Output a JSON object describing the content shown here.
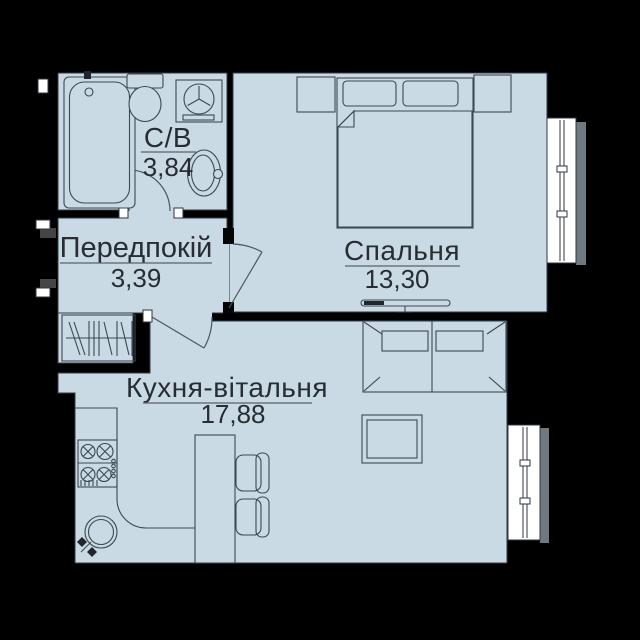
{
  "plan": {
    "title": "apartment-floor-plan",
    "background_color": "#000000",
    "floor_color": "#c9dae4",
    "line_color": "#3c4852",
    "text_color": "#272d33",
    "window_shadow_color": "#707880",
    "rooms": [
      {
        "name": "С/В",
        "area": "3,84"
      },
      {
        "name": "Передпокій",
        "area": "3,39"
      },
      {
        "name": "Спальня",
        "area": "13,30"
      },
      {
        "name": "Кухня-вітальня",
        "area": "17,88"
      }
    ],
    "fixtures": [
      "bathtub",
      "toilet",
      "washing-machine",
      "bathroom-sink",
      "wardrobe",
      "bed",
      "nightstand-left",
      "nightstand-right",
      "tv",
      "sofa",
      "coffee-table",
      "kitchen-counter",
      "stove",
      "kitchen-sink",
      "bar-table",
      "chair",
      "bedroom-window",
      "kitchen-window",
      "bathroom-door",
      "bedroom-door",
      "kitchen-door",
      "entrance-door"
    ]
  }
}
